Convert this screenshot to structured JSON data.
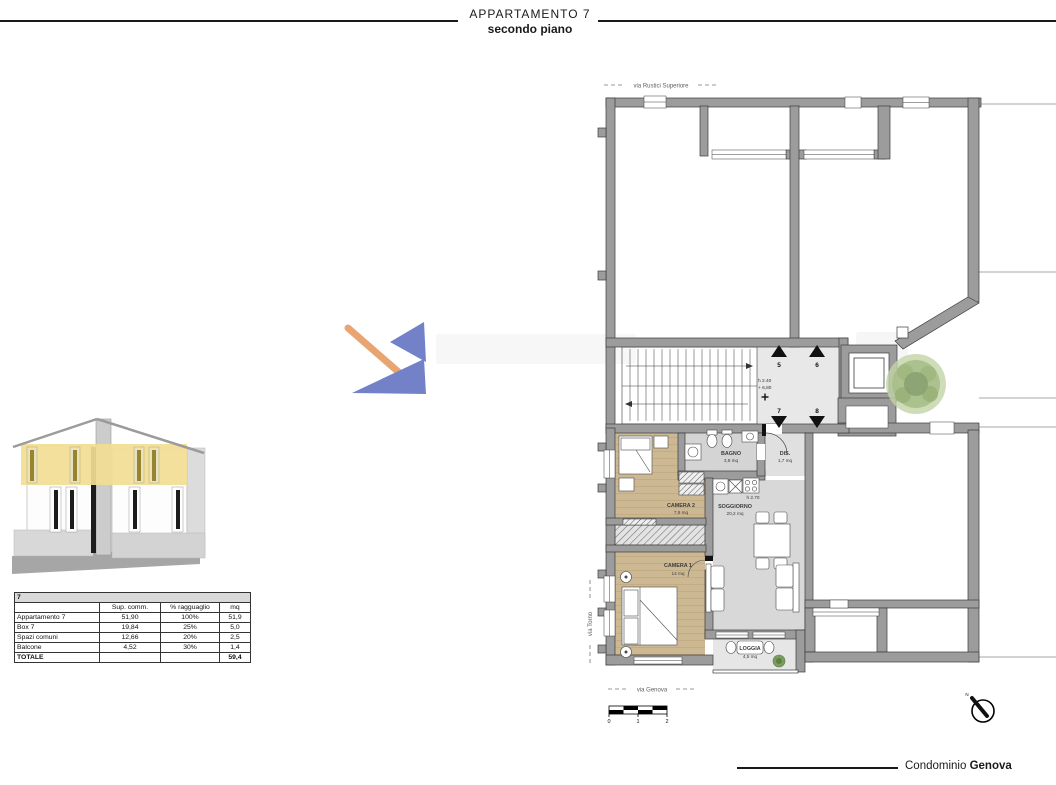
{
  "header": {
    "title": "APPARTAMENTO 7",
    "subtitle": "secondo piano"
  },
  "footer": {
    "label": "Condominio ",
    "label_bold": "Genova"
  },
  "area_table": {
    "title": "7",
    "col_label": "",
    "col_sup": "Sup. comm.",
    "col_perc": "% ragguaglio",
    "col_mq": "mq",
    "rows": [
      {
        "label": "Appartamento 7",
        "sup": "51,90",
        "perc": "100%",
        "mq": "51,9"
      },
      {
        "label": "Box 7",
        "sup": "19,84",
        "perc": "25%",
        "mq": "5,0"
      },
      {
        "label": "Spazi comuni",
        "sup": "12,66",
        "perc": "20%",
        "mq": "2,5"
      },
      {
        "label": "Balcone",
        "sup": "4,52",
        "perc": "30%",
        "mq": "1,4"
      }
    ],
    "total_label": "TOTALE",
    "total_mq": "59,4"
  },
  "plan": {
    "street_top": "via Rustici Superiore",
    "street_left": "via Torno",
    "street_bottom": "via Genova",
    "landing": {
      "height": "h 2.40",
      "quota": "+ 6,80",
      "unit5": "5",
      "unit6": "6",
      "unit7": "7",
      "unit8": "8"
    },
    "rooms": {
      "camera2": {
        "name": "CAMERA 2",
        "area": "7,9 mq"
      },
      "camera1": {
        "name": "CAMERA 1",
        "area": "14 mq"
      },
      "bagno": {
        "name": "BAGNO",
        "area": "3,8 mq"
      },
      "dis": {
        "name": "DIS.",
        "area": "1,7 mq"
      },
      "soggiorno": {
        "name": "SOGGIORNO",
        "area": "20,2 mq",
        "height": "h 2.70"
      },
      "loggia": {
        "name": "LOGGIA",
        "area": "4,5 mq"
      }
    },
    "scale_ticks": [
      "0",
      "1",
      "2"
    ],
    "compass": "N"
  },
  "colors": {
    "highlight_yellow": "#f2dd94",
    "wall_gray": "#9c9c9c",
    "wood": "#cdb894",
    "logo_blue": "#7381c8",
    "logo_orange": "#e8a572"
  }
}
